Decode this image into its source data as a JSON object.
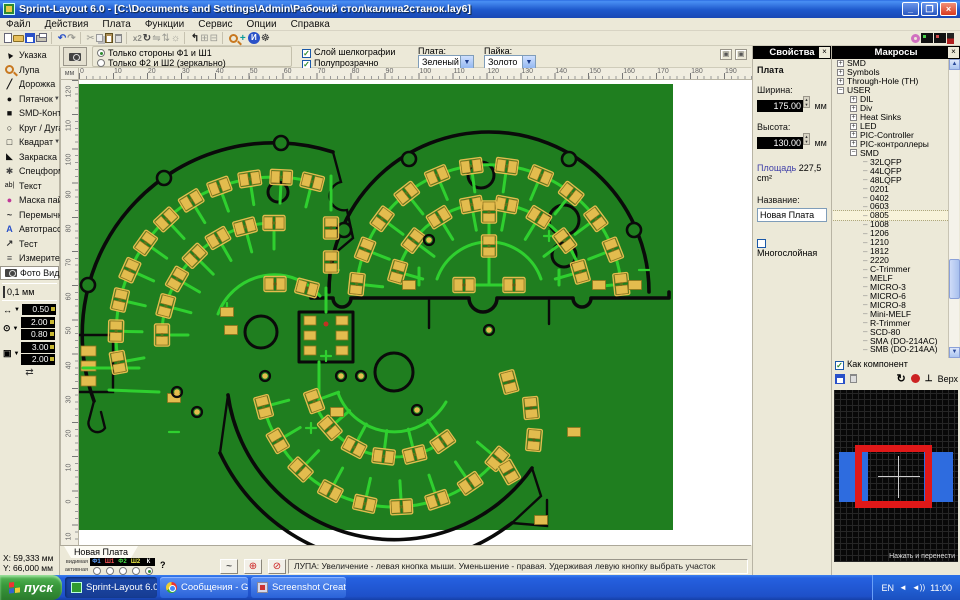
{
  "window": {
    "title": "Sprint-Layout 6.0 - [C:\\Documents and Settings\\Admin\\Рабочий стол\\калина2станок.lay6]",
    "controls": {
      "minimize": "_",
      "restore": "❐",
      "close": "×"
    }
  },
  "menu": [
    "Файл",
    "Действия",
    "Плата",
    "Функции",
    "Сервис",
    "Опции",
    "Справка"
  ],
  "toolbar": {
    "items": [
      {
        "name": "new-button",
        "css": "i-file"
      },
      {
        "name": "open-button",
        "css": "i-folder"
      },
      {
        "name": "save-button",
        "css": "i-save"
      },
      {
        "name": "print-button",
        "css": "i-print"
      },
      {
        "sep": 1
      },
      {
        "name": "undo-button",
        "glyph": "↶",
        "color": "#2a51c8",
        "bold": 1
      },
      {
        "name": "redo-button",
        "glyph": "↷",
        "color": "#9a9a93",
        "bold": 1
      },
      {
        "sep": 1
      },
      {
        "name": "cut-button",
        "glyph": "✂",
        "color": "#9a9a93"
      },
      {
        "name": "copy-button",
        "css": "i-copy"
      },
      {
        "name": "paste-button",
        "css": "i-paste"
      },
      {
        "name": "delete-button",
        "css": "i-trash"
      },
      {
        "sep": 1
      },
      {
        "name": "duplicate-button",
        "glyph": "x2",
        "color": "#8a8a84",
        "small": 1
      },
      {
        "name": "rotate-button",
        "glyph": "↻",
        "color": "#444",
        "bold": 1
      },
      {
        "name": "mirror-h-button",
        "glyph": "⇋",
        "color": "#9a9a93"
      },
      {
        "name": "mirror-v-button",
        "glyph": "⇅",
        "color": "#9a9a93"
      },
      {
        "name": "align-button",
        "glyph": "☼",
        "color": "#9a9a93"
      },
      {
        "sep": 1
      },
      {
        "name": "rotate-board-button",
        "glyph": "↰",
        "color": "#222",
        "bold": 1
      },
      {
        "name": "group-button",
        "glyph": "⊞",
        "color": "#9a9a93"
      },
      {
        "name": "ungroup-button",
        "glyph": "⊟",
        "color": "#9a9a93"
      },
      {
        "sep": 1
      },
      {
        "name": "zoom-tool-button",
        "css": "i-zoom"
      },
      {
        "name": "snap-button",
        "glyph": "+",
        "color": "#0a9a9a",
        "bold": 1
      },
      {
        "name": "info-button",
        "css": "i-info",
        "glyph": "И"
      },
      {
        "name": "settings-button",
        "glyph": "☸",
        "color": "#333"
      },
      {
        "gap": 640
      },
      {
        "name": "solder-mask-view-button",
        "css": "i-donut"
      },
      {
        "name": "layer-f1-view-button",
        "css": "i-chip"
      },
      {
        "name": "layer-f2-view-button",
        "css": "i-chip2"
      },
      {
        "name": "board-side-button",
        "css": "i-side"
      }
    ]
  },
  "photo_options": {
    "radio_top": "Только стороны Ф1 и Ш1",
    "radio_bottom": "Только Ф2 и Ш2 (зеркально)",
    "check_silk": "Слой шелкографии",
    "check_translucent": "Полупрозрачно",
    "board_label": "Плата:",
    "board_value": "Зеленый",
    "solder_label": "Пайка:",
    "solder_value": "Золото"
  },
  "tools": [
    {
      "name": "tool-pointer",
      "label": "Указка",
      "glyph": "▲",
      "cls": "g-cursor",
      "color": "#111"
    },
    {
      "name": "tool-zoom",
      "label": "Лупа",
      "css": "i-zoom"
    },
    {
      "name": "tool-track",
      "label": "Дорожка",
      "glyph": "╱",
      "color": "#111",
      "bold": 1
    },
    {
      "name": "tool-pad",
      "label": "Пятачок",
      "glyph": "●",
      "color": "#111",
      "dd": 1
    },
    {
      "name": "tool-smd-pad",
      "label": "SMD-Контакт",
      "glyph": "■",
      "color": "#111"
    },
    {
      "name": "tool-circle",
      "label": "Круг / Дуга",
      "glyph": "○",
      "color": "#111",
      "bold": 1
    },
    {
      "name": "tool-rect",
      "label": "Квадрат",
      "glyph": "□",
      "color": "#111",
      "dd": 1
    },
    {
      "name": "tool-fill",
      "label": "Закраска",
      "glyph": "◣",
      "color": "#111"
    },
    {
      "name": "tool-special",
      "label": "Спецформы",
      "glyph": "✱",
      "color": "#444"
    },
    {
      "name": "tool-text",
      "label": "Текст",
      "glyph": "ab|",
      "small": 1,
      "color": "#111"
    },
    {
      "name": "tool-solder-mask",
      "label": "Маска пайки",
      "glyph": "●",
      "color": "#c03898"
    },
    {
      "name": "tool-jumper",
      "label": "Перемычки",
      "glyph": "~",
      "color": "#333",
      "bold": 1
    },
    {
      "name": "tool-autoroute",
      "label": "Автотрасса",
      "glyph": "A",
      "color": "#2a51c8",
      "bold": 1
    },
    {
      "name": "tool-test",
      "label": "Тест",
      "glyph": "↗",
      "color": "#333",
      "bold": 1
    },
    {
      "name": "tool-measure",
      "label": "Измеритель",
      "glyph": "≡",
      "color": "#555"
    },
    {
      "name": "tool-photo-view",
      "label": "Фото Вид",
      "css": "i-cam",
      "active": 1
    }
  ],
  "grid": {
    "value": "0,1 мм"
  },
  "widths": {
    "track": "0.50",
    "pad_outer": "2.00",
    "pad_hole": "0.80",
    "smd_w": "3.00",
    "smd_h": "2.00"
  },
  "cursor_pos": {
    "x_label": "X:",
    "x": "59,333 мм",
    "y_label": "Y:",
    "y": "66,000 мм"
  },
  "rulers": {
    "unit": "мм",
    "top": [
      "0",
      "10",
      "20",
      "30",
      "40",
      "50",
      "60",
      "70",
      "80",
      "90",
      "100",
      "110",
      "120",
      "130",
      "140",
      "150",
      "160",
      "170",
      "180",
      "190"
    ],
    "left": [
      "120",
      "110",
      "100",
      "90",
      "80",
      "70",
      "60",
      "50",
      "40",
      "30",
      "20",
      "10",
      "0",
      "10"
    ]
  },
  "properties": {
    "title": "Свойства",
    "close": "×",
    "section": "Плата",
    "width_label": "Ширина:",
    "width_value": "175.00",
    "width_unit": "мм",
    "height_label": "Высота:",
    "height_value": "130.00",
    "height_unit": "мм",
    "area_label": "Площадь",
    "area_value": "227,5 cm²",
    "name_label": "Название:",
    "name_value": "Новая Плата",
    "multilayer_label": "Многослойная"
  },
  "macros": {
    "title": "Макросы",
    "close": "×",
    "tree": [
      {
        "l": 0,
        "e": "+",
        "t": "SMD"
      },
      {
        "l": 0,
        "e": "+",
        "t": "Symbols"
      },
      {
        "l": 0,
        "e": "+",
        "t": "Through-Hole (TH)"
      },
      {
        "l": 0,
        "e": "-",
        "t": "USER"
      },
      {
        "l": 1,
        "e": "+",
        "t": "DIL"
      },
      {
        "l": 1,
        "e": "+",
        "t": "Div"
      },
      {
        "l": 1,
        "e": "+",
        "t": "Heat Sinks"
      },
      {
        "l": 1,
        "e": "+",
        "t": "LED"
      },
      {
        "l": 1,
        "e": "+",
        "t": "PIC-Controller"
      },
      {
        "l": 1,
        "e": "+",
        "t": "PIC-контроллеры"
      },
      {
        "l": 1,
        "e": "-",
        "t": "SMD"
      },
      {
        "l": 2,
        "t": "32LQFP"
      },
      {
        "l": 2,
        "t": "44LQFP"
      },
      {
        "l": 2,
        "t": "48LQFP"
      },
      {
        "l": 2,
        "t": "0201"
      },
      {
        "l": 2,
        "t": "0402"
      },
      {
        "l": 2,
        "t": "0603"
      },
      {
        "l": 2,
        "t": "0805",
        "sel": 1
      },
      {
        "l": 2,
        "t": "1008"
      },
      {
        "l": 2,
        "t": "1206"
      },
      {
        "l": 2,
        "t": "1210"
      },
      {
        "l": 2,
        "t": "1812"
      },
      {
        "l": 2,
        "t": "2220"
      },
      {
        "l": 2,
        "t": "C-Trimmer"
      },
      {
        "l": 2,
        "t": "MELF"
      },
      {
        "l": 2,
        "t": "MICRO-3"
      },
      {
        "l": 2,
        "t": "MICRO-6"
      },
      {
        "l": 2,
        "t": "MICRO-8"
      },
      {
        "l": 2,
        "t": "Mini-MELF"
      },
      {
        "l": 2,
        "t": "R-Trimmer"
      },
      {
        "l": 2,
        "t": "SCD-80"
      },
      {
        "l": 2,
        "t": "SMA (DO-214AC)"
      },
      {
        "l": 2,
        "t": "SMB (DO-214AA)"
      }
    ],
    "selected": "0805",
    "as_component_label": "Как компонент",
    "side_label": "Верх",
    "preview_hint": "Нажать и перенести"
  },
  "board_tab": "Новая Плата",
  "status": {
    "visible_label": "видимая",
    "active_label": "активная",
    "layers": [
      {
        "name": "Ф1",
        "color": "#5aa0ff"
      },
      {
        "name": "Ш1",
        "color": "#ff5555"
      },
      {
        "name": "Ф2",
        "color": "#44dd44"
      },
      {
        "name": "Ш2",
        "color": "#eeee44"
      },
      {
        "name": "К",
        "color": "#ffffff"
      }
    ],
    "active_layer": "К",
    "help_mark": "?",
    "hint": "ЛУПА: Увеличение - левая кнопка мыши. Уменьшение - правая. Удерживая левую кнопку выбрать участок"
  },
  "taskbar": {
    "start": "пуск",
    "tasks": [
      {
        "label": "Sprint-Layout 6.0",
        "icon": "sprint",
        "active": 1
      },
      {
        "label": "Сообщения - Google ...",
        "icon": "chrome"
      },
      {
        "label": "Screenshot Creator",
        "icon": "shot"
      }
    ],
    "tray": {
      "lang": "EN",
      "time": "11:00"
    }
  },
  "pcb": {
    "colors": {
      "board": "#1f7e1f",
      "trace": "#2fd02f",
      "pad": "#e3bc4e",
      "padline": "#8f731f",
      "outline": "#0a0a0a",
      "canvas": "#ffffff"
    },
    "fans": [
      {
        "cx": 195,
        "cy": 255,
        "arcs": [
          {
            "r": 158,
            "a0": 170,
            "a1": 284,
            "n": 11
          },
          {
            "r": 112,
            "a0": 180,
            "a1": 270,
            "n": 7
          }
        ]
      },
      {
        "cx": 410,
        "cy": 218,
        "arcs": [
          {
            "r": 133,
            "a0": 186,
            "a1": 354,
            "n": 12
          },
          {
            "r": 95,
            "a0": 196,
            "a1": 344,
            "n": 8
          }
        ]
      },
      {
        "cx": 315,
        "cy": 292,
        "arcs": [
          {
            "r": 135,
            "a0": 40,
            "a1": 165,
            "n": 9
          },
          {
            "r": 85,
            "a0": 55,
            "a1": 160,
            "n": 6
          }
        ]
      }
    ],
    "extra_pads": [
      [
        252,
        148,
        90
      ],
      [
        252,
        182,
        90
      ],
      [
        228,
        208,
        15
      ],
      [
        196,
        204,
        0
      ],
      [
        385,
        205,
        0
      ],
      [
        435,
        205,
        0
      ],
      [
        410,
        132,
        90
      ],
      [
        410,
        166,
        90
      ],
      [
        430,
        302,
        75
      ],
      [
        452,
        328,
        85
      ],
      [
        455,
        360,
        95
      ],
      [
        430,
        392,
        60
      ]
    ],
    "singles": [
      [
        152,
        250
      ],
      [
        95,
        318
      ],
      [
        258,
        332
      ],
      [
        330,
        205
      ],
      [
        520,
        205
      ],
      [
        462,
        440
      ],
      [
        495,
        352
      ],
      [
        556,
        205
      ],
      [
        148,
        232
      ]
    ],
    "vias": [
      [
        98,
        312
      ],
      [
        118,
        332
      ],
      [
        186,
        296
      ],
      [
        262,
        296
      ],
      [
        282,
        296
      ],
      [
        350,
        160
      ],
      [
        338,
        330
      ],
      [
        410,
        250
      ]
    ]
  }
}
